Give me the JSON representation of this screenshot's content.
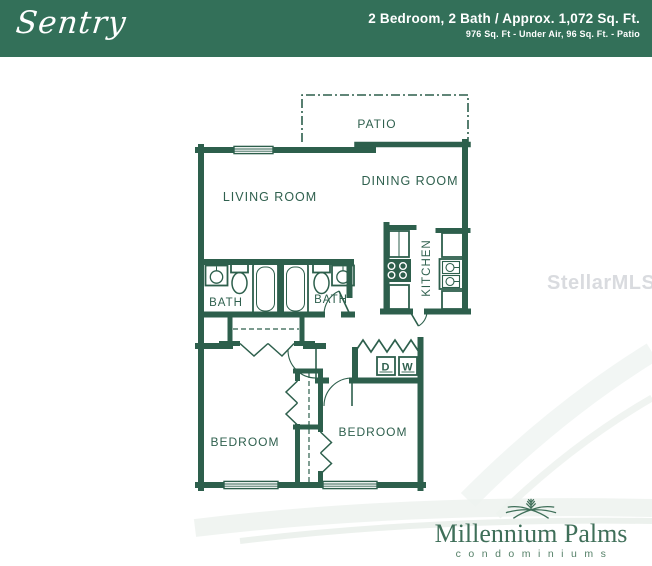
{
  "header": {
    "plan_name": "Sentry",
    "specs_line1": "2 Bedroom, 2 Bath / Approx. 1,072 Sq. Ft.",
    "specs_line2": "976 Sq. Ft - Under Air, 96 Sq. Ft. - Patio",
    "background_color": "#337059",
    "text_color": "#FFFFFF"
  },
  "floorplan": {
    "line_color": "#2D5F4C",
    "rooms": {
      "patio": "PATIO",
      "living_room": "LIVING ROOM",
      "dining_room": "DINING ROOM",
      "kitchen": "KITCHEN",
      "bath_left": "BATH",
      "bath_right": "BATH",
      "bedroom_left": "BEDROOM",
      "bedroom_right": "BEDROOM"
    },
    "appliances": {
      "dryer": "D",
      "washer": "W"
    }
  },
  "watermark": {
    "text": "StellarMLS"
  },
  "logo": {
    "name": "Millennium Palms",
    "subtitle": "condominiums",
    "color": "#3F6F59"
  }
}
